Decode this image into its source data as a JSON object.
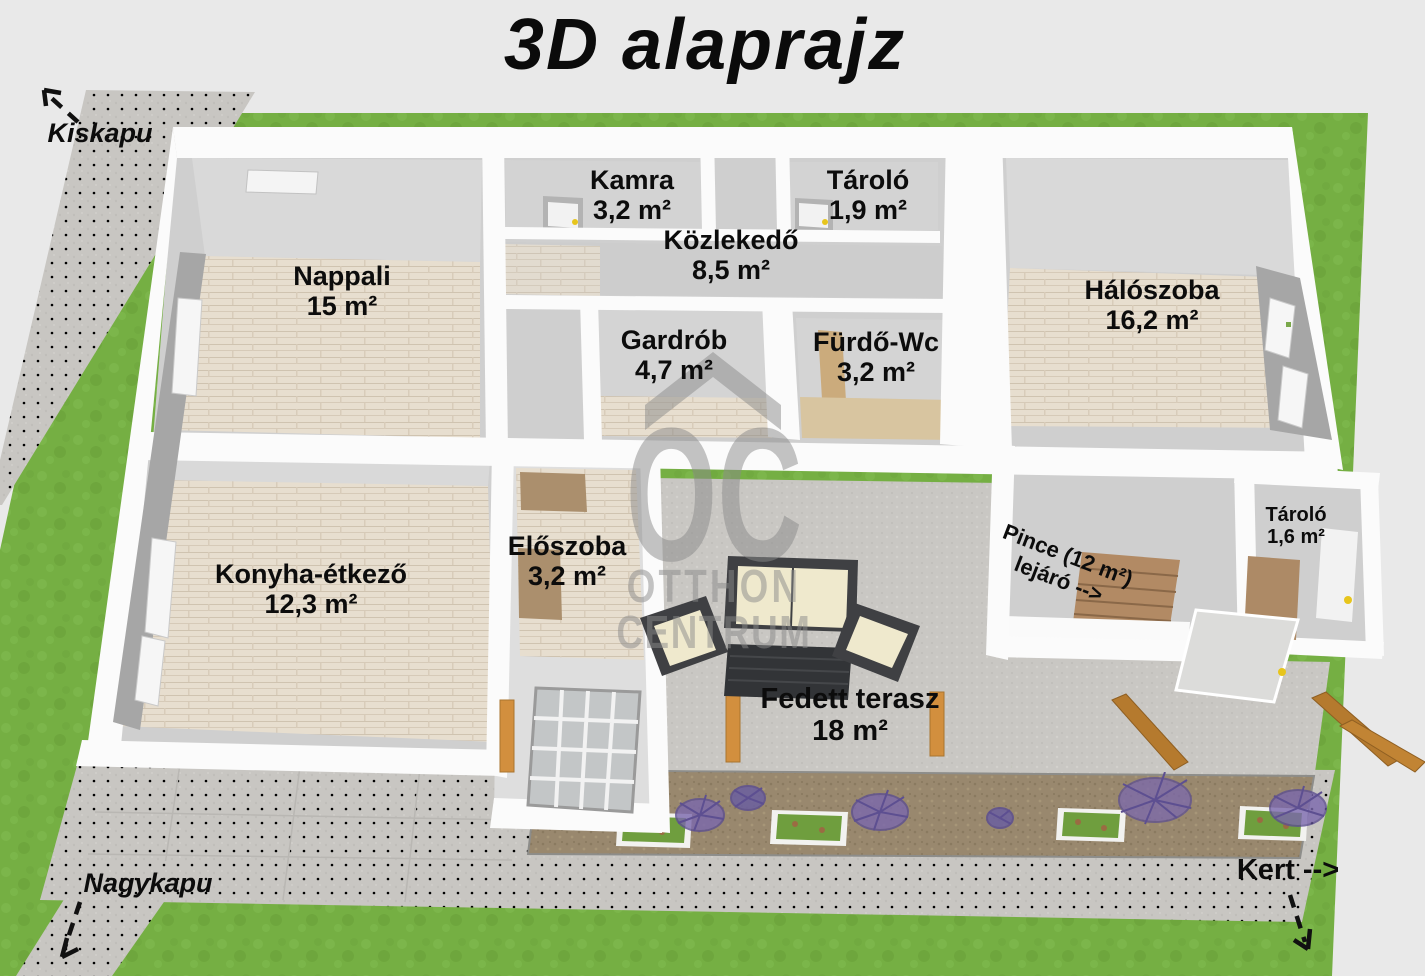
{
  "title": "3D alaprajz",
  "watermark": {
    "monogram": "OC",
    "line1": "OTTHON",
    "line2": "CENTRUM"
  },
  "outdoor_labels": {
    "kiskapu": "Kiskapu",
    "nagykapu": "Nagykapu",
    "kert": "Kert -->"
  },
  "rooms": [
    {
      "name": "Nappali",
      "area": "15 m²"
    },
    {
      "name": "Kamra",
      "area": "3,2 m²"
    },
    {
      "name": "Tároló",
      "area": "1,9 m²"
    },
    {
      "name": "Közlekedő",
      "area": "8,5 m²"
    },
    {
      "name": "Gardrób",
      "area": "4,7 m²"
    },
    {
      "name": "Fürdő-Wc",
      "area": "3,2 m²"
    },
    {
      "name": "Hálószoba",
      "area": "16,2 m²"
    },
    {
      "name": "Konyha-étkező",
      "area": "12,3 m²"
    },
    {
      "name": "Előszoba",
      "area": "3,2 m²"
    },
    {
      "name": "Tároló",
      "area": "1,6 m²"
    },
    {
      "name": "Fedett terasz",
      "area": "18 m²"
    }
  ],
  "annotations": {
    "pince_line1": "Pince (12 m²)",
    "pince_line2": "lejáró -->"
  },
  "colors": {
    "background": "#e9e9e9",
    "grass": "#76b044",
    "path_gray": "#c8c6c2",
    "wall_white": "#fbfbfb",
    "wall_gray": "#cfcfcf",
    "wall_dark_face": "#a6a6a6",
    "wood_floor": "#e7decf",
    "tile_beige": "#d8c5a0",
    "terrace_concrete": "#c9c7c3",
    "soil": "#99886e",
    "lavender": "#7b68ad",
    "wood_post": "#d28f3e",
    "sofa_dark": "#3f4043",
    "cushion_cream": "#efe9cd",
    "door_handle_yellow": "#e7c51c",
    "label_black": "#0c0c0c",
    "watermark_gray": "#8a8a8a"
  }
}
